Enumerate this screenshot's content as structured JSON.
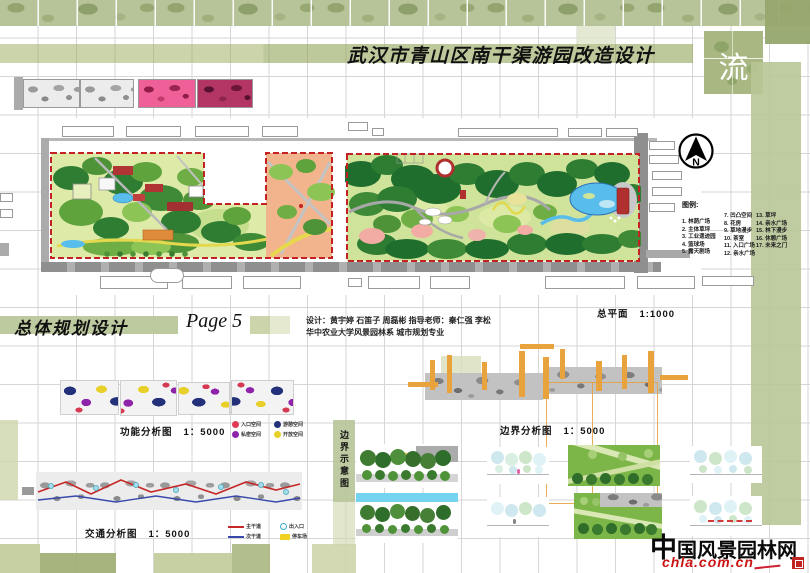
{
  "board": {
    "title": "武汉市青山区南干渠游园改造设计",
    "corner_glyph": "流",
    "section_title": "总体规划设计",
    "page_label": "Page 5",
    "credits_line1": "设计：黄宇婷  石笛子  周磊彬    指导老师：秦仁强  李松",
    "credits_line2": "华中农业大学风景园林系    城市规划专业"
  },
  "master_plan": {
    "caption": "总平面",
    "scale": "1:1000",
    "north_label": "N",
    "legend": {
      "title": "图例:",
      "columns": [
        {
          "items": [
            "1. 林荫广场",
            "2. 主体草坪",
            "3. 工业遗迹园",
            "4. 篮球场",
            "5. 露天剧场"
          ]
        },
        {
          "items": [
            "7. 凹凸空间",
            "8. 花房",
            "9. 草地漫步",
            "10. 茶室",
            "11. 入口广场",
            "12. 亲水广场"
          ]
        },
        {
          "items": [
            "13. 草坪",
            "14. 亲水广场",
            "15. 林下漫步",
            "16. 休憩广场",
            "17. 未来之门"
          ]
        }
      ]
    }
  },
  "diagrams": {
    "function": {
      "title": "功能分析图",
      "scale": "1：5000",
      "legend": [
        {
          "label": "入口空间",
          "color": "#e03a55"
        },
        {
          "label": "私密空间",
          "color": "#8e24aa"
        },
        {
          "label": "游憩空间",
          "color": "#223179"
        },
        {
          "label": "开放空间",
          "color": "#e8cf2a"
        }
      ]
    },
    "boundary": {
      "title": "边界分析图",
      "scale": "1：5000"
    },
    "boundary_sketch": {
      "title": "边界示意图"
    },
    "traffic": {
      "title": "交通分析图",
      "scale": "1：5000",
      "legend": [
        {
          "label": "主干道",
          "color": "#c62828",
          "type": "line"
        },
        {
          "label": "次干道",
          "color": "#3949ab",
          "type": "line"
        },
        {
          "label": "出入口",
          "color": "#3ab0c9",
          "type": "circle"
        },
        {
          "label": "停车场",
          "color": "#f0d020",
          "type": "swatch"
        }
      ]
    }
  },
  "watermark": {
    "site_char": "中",
    "site_rest": "国风景园林网",
    "url": "chla.com.cn"
  }
}
